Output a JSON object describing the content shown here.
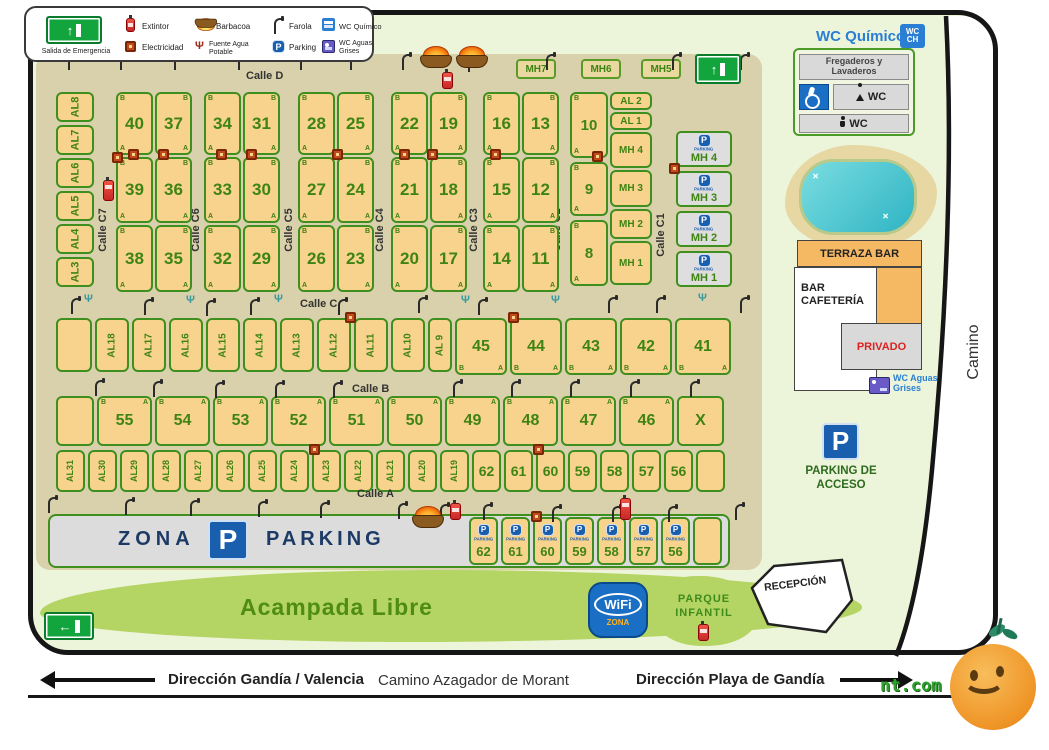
{
  "legend": {
    "salida": "Salida de Emergencia",
    "extintor": "Extintor",
    "electricidad": "Electricidad",
    "barbacoa": "Barbacoa",
    "fuente": "Fuente Agua Potable",
    "farola": "Farola",
    "parking": "Parking",
    "wc_quimico": "WC Químico",
    "wc_aguas": "WC Aguas Grises"
  },
  "icons": {
    "p": "P",
    "arrow_up": "↑",
    "arrow_left": "←",
    "arrow_right": "→",
    "fuente_glyph": "Ψ",
    "wifi": "WiFi",
    "wifi_zona": "ZONA",
    "wc": "WC",
    "ch": "CH"
  },
  "letters": {
    "a": "A",
    "b": "B"
  },
  "streets": {
    "calle_d": "Calle D",
    "calle_c": "Calle C",
    "calle_b": "Calle B",
    "calle_a": "Calle A",
    "vertical": [
      "Calle C7",
      "Calle C6",
      "Calle C5",
      "Calle C4",
      "Calle C3",
      "Calle C2",
      "Calle C1"
    ],
    "camino": "Camino"
  },
  "top_mh": [
    "MH7",
    "MH6",
    "MH5"
  ],
  "left_al": [
    "AL8",
    "AL7",
    "AL6",
    "AL5",
    "AL4",
    "AL3"
  ],
  "blocks": [
    {
      "cells": [
        "40",
        "37",
        "39",
        "36",
        "38",
        "35"
      ]
    },
    {
      "cells": [
        "34",
        "31",
        "33",
        "30",
        "32",
        "29"
      ]
    },
    {
      "cells": [
        "28",
        "25",
        "27",
        "24",
        "26",
        "23"
      ]
    },
    {
      "cells": [
        "22",
        "19",
        "21",
        "18",
        "20",
        "17"
      ]
    },
    {
      "cells": [
        "16",
        "13",
        "15",
        "12",
        "14",
        "11"
      ]
    }
  ],
  "block6": {
    "left": [
      "10",
      "9",
      "8"
    ],
    "al": [
      "AL 2",
      "AL 1"
    ],
    "mh": [
      "MH 4",
      "MH 3",
      "MH 2",
      "MH 1"
    ]
  },
  "mh_parking": {
    "label": "PARKING",
    "names": [
      "MH 4",
      "MH 3",
      "MH 2",
      "MH 1"
    ]
  },
  "row_c": {
    "al": [
      "AL18",
      "AL17",
      "AL16",
      "AL15",
      "AL14",
      "AL13",
      "AL12",
      "AL11",
      "AL10",
      "AL 9"
    ],
    "nums": [
      "45",
      "44",
      "43",
      "42",
      "41"
    ]
  },
  "row_b": {
    "nums": [
      "55",
      "54",
      "53",
      "52",
      "51",
      "50",
      "49",
      "48",
      "47",
      "46"
    ],
    "x": "X"
  },
  "row_a": {
    "al": [
      "AL31",
      "AL30",
      "AL29",
      "AL28",
      "AL27",
      "AL26",
      "AL25",
      "AL24",
      "AL23",
      "AL22",
      "AL21",
      "AL20",
      "AL19"
    ],
    "nums": [
      "62",
      "61",
      "60",
      "59",
      "58",
      "57",
      "56"
    ]
  },
  "zona_parking": {
    "zona": "ZONA",
    "parking": "PARKING",
    "cell_label": "PARKING",
    "cells": [
      "62",
      "61",
      "60",
      "59",
      "58",
      "57",
      "56"
    ]
  },
  "facilities": {
    "wc_quimico": "WC Químico",
    "fregaderos": "Fregaderos y Lavaderos",
    "wc": "WC",
    "terraza": "TERRAZA BAR",
    "bar": "BAR CAFETERÍA",
    "privado": "PRIVADO",
    "wc_aguas": "WC Aguas Grises",
    "parking_acceso": "PARKING DE ACCESO"
  },
  "south": {
    "acampada": "Acampada Libre",
    "parque": "PARQUE INFANTIL",
    "recepcion": "RECEPCIÓN"
  },
  "road": {
    "left": "Dirección Gandía / Valencia",
    "center": "Camino Azagador de Morant",
    "right": "Dirección Playa de Gandía"
  },
  "watermark": "nt.com",
  "colors": {
    "plot_fill": "#f8d38d",
    "plot_border": "#3f8f1f",
    "road_tan": "#d9d1ab",
    "map_green": "#ecf4da",
    "accent_blue": "#1a5fae",
    "label_green": "#3e8413"
  }
}
